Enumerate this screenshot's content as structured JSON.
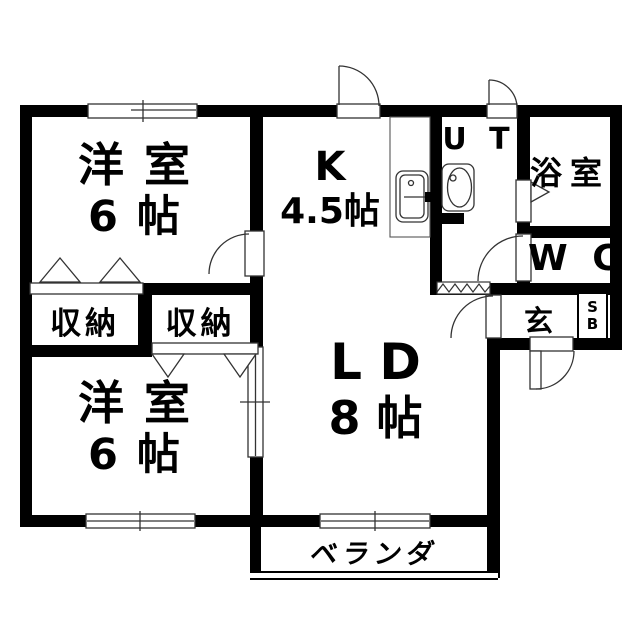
{
  "rooms": {
    "bedroom_top": {
      "line1": "洋 室",
      "line2": "6 帖"
    },
    "bedroom_bottom": {
      "line1": "洋 室",
      "line2": "6 帖"
    },
    "closet_left": {
      "label": "収納"
    },
    "closet_right": {
      "label": "収納"
    },
    "kitchen": {
      "line1": "K",
      "line2": "4.5帖"
    },
    "living_dining": {
      "line1": "L D",
      "line2": "8 帖"
    },
    "utility": {
      "label": "U T"
    },
    "bathroom": {
      "label": "浴室"
    },
    "toilet": {
      "label": "W C"
    },
    "entrance": {
      "label": "玄"
    },
    "shoe_box": {
      "line1": "S",
      "line2": "B"
    },
    "veranda": {
      "label": "ベランダ"
    }
  },
  "colors": {
    "wall": "#000000",
    "thin_line": "#333333",
    "background": "#ffffff",
    "text": "#000000"
  }
}
